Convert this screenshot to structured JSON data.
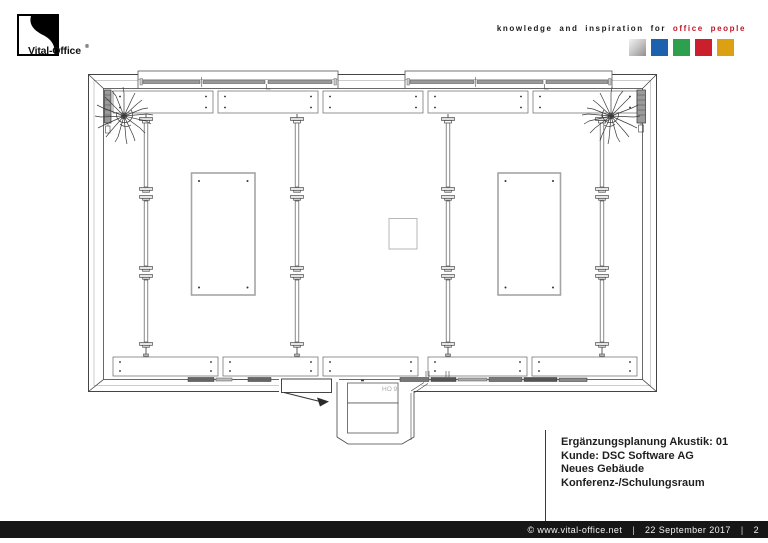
{
  "header": {
    "logo": {
      "text": "Vital-Office",
      "reg": "®"
    },
    "tagline": {
      "black": "knowledge and inspiration for",
      "red": "office people"
    },
    "palette": [
      {
        "name": "silver",
        "css": "background:linear-gradient(135deg,#f2f2f2 0%,#c9c9c9 45%,#8f8f8f 100%)"
      },
      {
        "name": "blue",
        "css": "background:#1b61ae"
      },
      {
        "name": "green",
        "css": "background:#2ca04c"
      },
      {
        "name": "red",
        "css": "background:#cc1f2e"
      },
      {
        "name": "amber",
        "css": "background:#dba112"
      }
    ]
  },
  "plan": {
    "room_label": "HO 9"
  },
  "title_block": {
    "lines": [
      "Ergänzungsplanung Akustik: 01",
      "Kunde: DSC Software AG",
      "Neues Gebäude",
      "Konferenz-/Schulungsraum"
    ]
  },
  "footer": {
    "copyright": "© www.vital-office.net",
    "separator": "|",
    "date": "22 September 2017",
    "page": "2"
  },
  "colors": {
    "accent_red": "#c41425",
    "footer_bg": "#161616",
    "line": "#4a4a4a"
  }
}
